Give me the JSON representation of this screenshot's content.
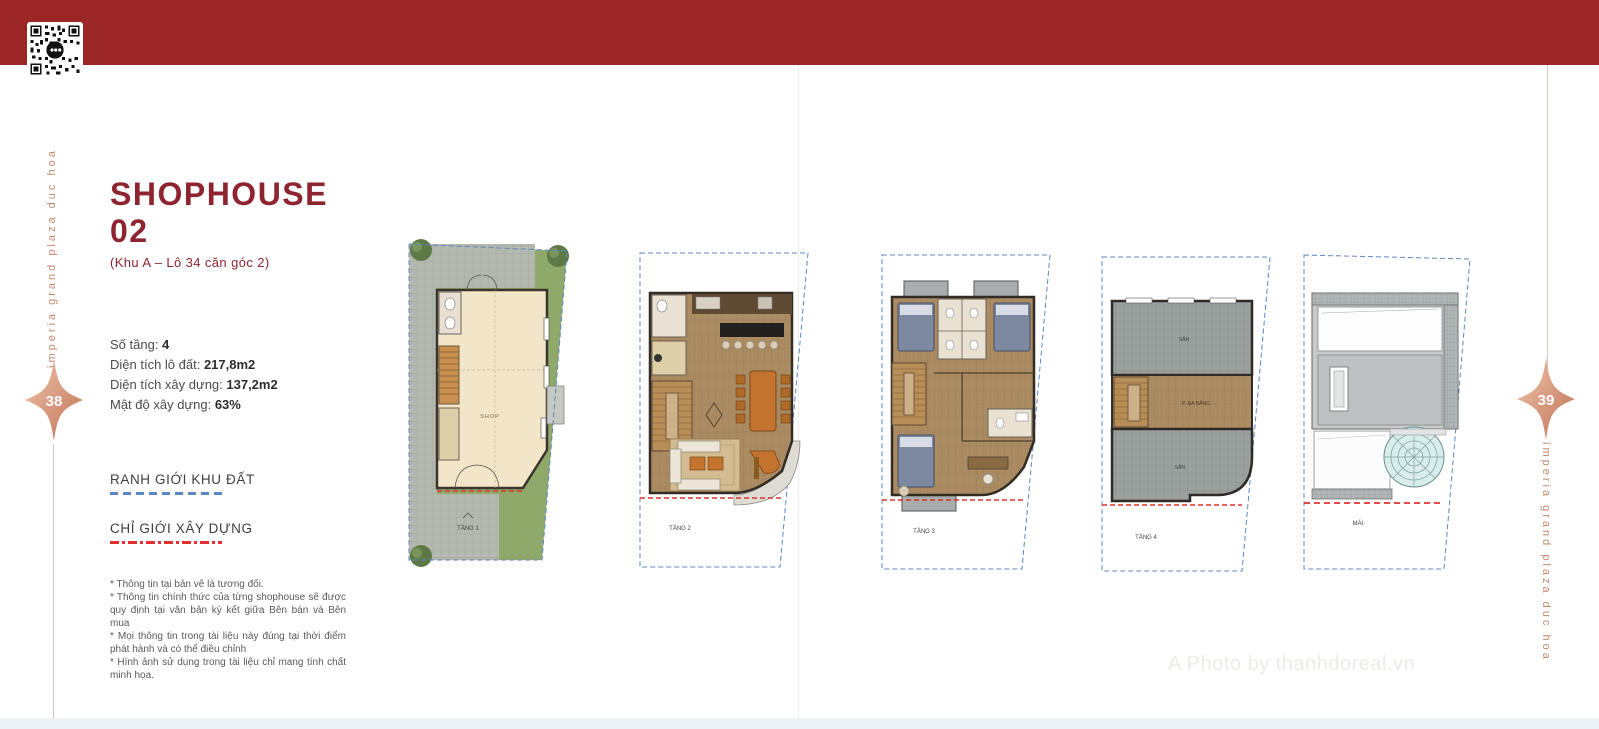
{
  "page": {
    "left_page_number": "38",
    "right_page_number": "39",
    "side_text_left": "imperia grand plaza duc hoa",
    "side_text_right": "imperia grand plaza duc hoa",
    "watermark": "A Photo by thanhdoreal.vn"
  },
  "header": {
    "title_line1": "SHOPHOUSE",
    "title_line2": "02",
    "subtitle": "(Khu A – Lô 34 căn góc 2)"
  },
  "specs": [
    {
      "label": "Số tầng: ",
      "value": "4"
    },
    {
      "label": "Diện tích lô đất: ",
      "value": "217,8m2"
    },
    {
      "label": "Diện tích xây dựng: ",
      "value": "137,2m2"
    },
    {
      "label": "Mật độ xây dựng: ",
      "value": "63%"
    }
  ],
  "legend": [
    {
      "label": "RANH GIỚI KHU ĐẤT",
      "line_style": "blue-dashed",
      "color": "#5b87c5"
    },
    {
      "label": "CHỈ GIỚI XÂY DỰNG",
      "line_style": "red-dash-dot",
      "color": "#e03030"
    }
  ],
  "notes": [
    "* Thông tin tại bản vẽ là tương đối.",
    "* Thông tin chính thức của từng shophouse sẽ được quy định tại văn bản ký kết giữa Bên bán và Bên mua",
    "* Mọi thông tin trong tài liệu này đúng tại thời điểm phát hành và có thể điều chỉnh",
    "* Hình ảnh sử dụng trong tài liệu chỉ mang tính chất minh họa."
  ],
  "plans": [
    {
      "label": "TẦNG 1",
      "room": "SHOP"
    },
    {
      "label": "TẦNG 2"
    },
    {
      "label": "TẦNG 3"
    },
    {
      "label": "TẦNG 4",
      "top_terrace": "SÂN",
      "room": "P. ĐA NĂNG",
      "bottom_terrace": "SÂN"
    },
    {
      "label": "MÁI"
    }
  ],
  "colors": {
    "banner_red": "#9b2626",
    "title_maroon": "#8e2430",
    "rose_copper": "#c18a6d",
    "boundary_blue": "#5b87c5",
    "setback_red": "#e03030",
    "garden_green": "#8fa96a",
    "wood_floor": "#ab8b62",
    "shop_beige": "#f3e6c8"
  }
}
